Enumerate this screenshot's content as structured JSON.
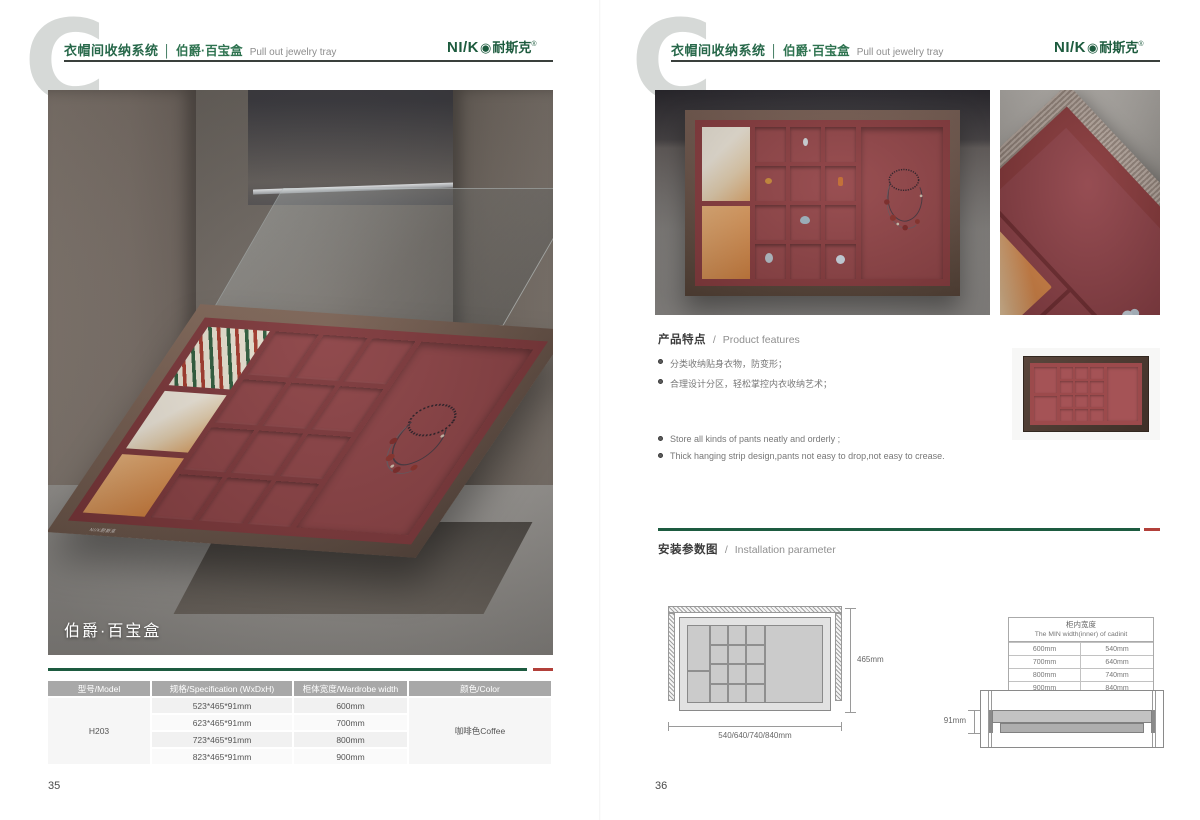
{
  "colors": {
    "brand_green": "#1d5b3e",
    "accent_red": "#b2403a",
    "tray_red": "#8c3e41",
    "frame_brown": "#5a463c",
    "table_header_bg": "#a8a8a8"
  },
  "brand": {
    "logo_en": "NI/K",
    "logo_o": "◉",
    "logo_cn": "耐斯克",
    "logo_reg": "®"
  },
  "header": {
    "watermark": "C",
    "series": "衣帽间收纳系统",
    "separator": "│",
    "product_cn": "伯爵·百宝盒",
    "product_en": "Pull out jewelry tray"
  },
  "left_page": {
    "page_number": "35",
    "photo_caption": "伯爵·百宝盒",
    "spec_table": {
      "headers": [
        "型号/Model",
        "规格/Specification (WxDxH)",
        "柜体宽度/Wardrobe width",
        "颜色/Color"
      ],
      "model": "H203",
      "rows": [
        {
          "spec": "523*465*91mm",
          "width": "600mm"
        },
        {
          "spec": "623*465*91mm",
          "width": "700mm"
        },
        {
          "spec": "723*465*91mm",
          "width": "800mm"
        },
        {
          "spec": "823*465*91mm",
          "width": "900mm"
        }
      ],
      "color": "咖啡色Coffee"
    }
  },
  "right_page": {
    "page_number": "36",
    "features": {
      "title_cn": "产品特点",
      "separator": "/",
      "title_en": "Product features",
      "bullets_cn": [
        "分类收纳贴身衣物，防变形；",
        "合理设计分区，轻松掌控内衣收纳艺术；"
      ],
      "bullets_en": [
        "Store all kinds of pants neatly and orderly ;",
        "Thick hanging strip design,pants not easy to drop,not easy to crease."
      ]
    },
    "installation": {
      "title_cn": "安装参数图",
      "separator": "/",
      "title_en": "Installation parameter",
      "top_view": {
        "depth_label": "465mm",
        "width_label": "540/640/740/840mm"
      },
      "side_view": {
        "height_label": "91mm"
      },
      "width_table": {
        "header_cn": "柜内宽度",
        "header_en": "The MIN width(inner) of cadinit",
        "rows": [
          {
            "wardrobe": "600mm",
            "inner": "540mm"
          },
          {
            "wardrobe": "700mm",
            "inner": "640mm"
          },
          {
            "wardrobe": "800mm",
            "inner": "740mm"
          },
          {
            "wardrobe": "900mm",
            "inner": "840mm"
          }
        ]
      }
    }
  }
}
